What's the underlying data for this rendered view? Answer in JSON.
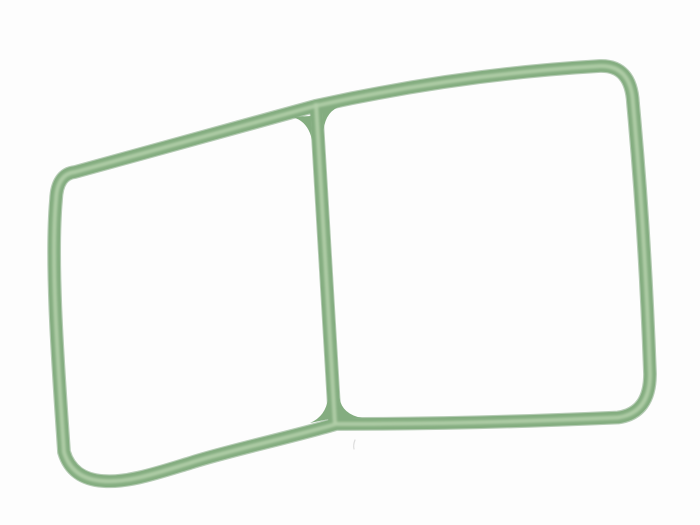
{
  "image": {
    "subject": "Green rubber sealing gasket (two-chamber O-ring style seal with center crossbar) photographed on a plain white background",
    "background": "#fdfdfd"
  },
  "gasket": {
    "material_colors": {
      "rim": "#6d9a6c",
      "body": "#84ad80",
      "highlight": "#b4d0aa"
    },
    "stroke": {
      "rim_width": 13.8,
      "ring_width": 11.5,
      "bar_width": 12,
      "highlight_width": 4.2,
      "rim_opacity": 0.5,
      "highlight_opacity": 0.85
    },
    "paths": {
      "outer_ring": "M 75,172 L 315,106 Q 460,74 600,66 Q 631,65 633,103 C 642,200 647,290 650,374 Q 650,413 618,417.5 Q 470,424 336,424 C 296,436 223,452 190,463 C 157,473 128,483 103,481 Q 72,479 64,452 C 60,390 50,268 56,200 Q 57,174 75,172 Z",
      "crossbar": "M 316,103 L 335,424",
      "fillet_top_left": "M 292,117 L 311,116 L 312,140 Q 308,121 292,117 Z",
      "fillet_top_right": "M 342,106 L 322,104 L 323.5,130 Q 326,110 342,106 Z",
      "fillet_bottom_left": "M 310,423 L 329,419 L 328,398 Q 326,416 310,423 Z",
      "fillet_bottom_right": "M 362,418 L 340,419 L 339.5,398 Q 342,414 362,418 Z"
    }
  },
  "artifacts": {
    "dust_speck_path": "M 355,440 Q 353,445 354,449",
    "dust_color": "#c8c8c8",
    "dust_opacity": 0.6
  }
}
